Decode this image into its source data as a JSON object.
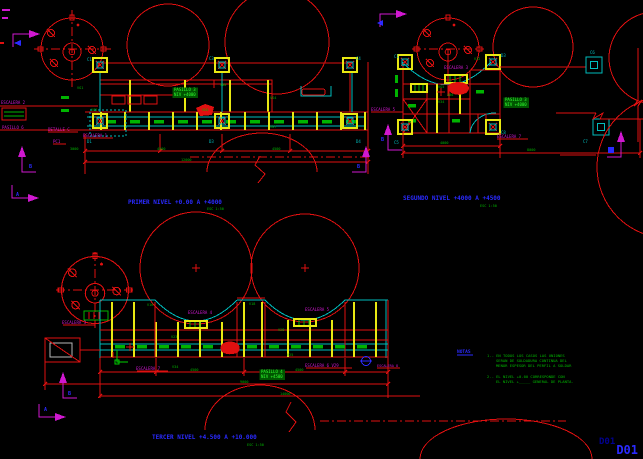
{
  "meta": {
    "sheet_code": "D01",
    "background": "#000000",
    "app_kind": "cad-model-space"
  },
  "palette": {
    "red": "#e01010",
    "yellow": "#e8e812",
    "green": "#00b400",
    "hl": "#30ff30",
    "hl_bg": "#005500",
    "cyan": "#00bcbc",
    "magenta": "#d018d0",
    "blue": "#2a2aff",
    "navy": "#000090",
    "gray": "#b8b8b8"
  },
  "drawings_summary": [
    {
      "id": "primer-nivel",
      "title": "PRIMER NIVEL +0.00 A +4000",
      "scale": "ESC 1:50"
    },
    {
      "id": "segundo-nivel",
      "title": "SEGUNDO NIVEL +4000 A +4500",
      "scale": "ESC 1:50"
    },
    {
      "id": "tercer-nivel",
      "title": "TERCER NIVEL +4.500 A +10.000",
      "scale": "ESC 1:50"
    }
  ],
  "texts": [
    {
      "name": "grid-bubble-c1",
      "t": "C1",
      "x": 87,
      "y": 61,
      "c": "cyan"
    },
    {
      "name": "grid-bubble-c3",
      "t": "C3",
      "x": 209,
      "y": 60,
      "c": "cyan"
    },
    {
      "name": "grid-bubble-c4",
      "t": "C4",
      "x": 356,
      "y": 60,
      "c": "cyan"
    },
    {
      "name": "grid-bubble-d1",
      "t": "D1",
      "x": 87,
      "y": 143,
      "c": "cyan"
    },
    {
      "name": "grid-bubble-d3",
      "t": "D3",
      "x": 209,
      "y": 143,
      "c": "cyan"
    },
    {
      "name": "grid-bubble-d4",
      "t": "D4",
      "x": 356,
      "y": 143,
      "c": "cyan"
    },
    {
      "name": "beam-label",
      "t": "VG1",
      "x": 77,
      "y": 89,
      "c": "green",
      "s": 3.5
    },
    {
      "name": "beam-label",
      "t": "VG5",
      "x": 91,
      "y": 111,
      "c": "green",
      "s": 3.5
    },
    {
      "name": "beam-label",
      "t": "VG4",
      "x": 202,
      "y": 111,
      "c": "green",
      "s": 3.5
    },
    {
      "name": "beam-label",
      "t": "VS4",
      "x": 270,
      "y": 99,
      "c": "green",
      "s": 3.5
    },
    {
      "name": "beam-label",
      "t": "VG7",
      "x": 270,
      "y": 128,
      "c": "green",
      "s": 3.5
    },
    {
      "name": "elev-label",
      "t": "400",
      "x": 220,
      "y": 86,
      "c": "green",
      "s": 3.5
    },
    {
      "name": "pasillo-note",
      "t": "PASILLO 3",
      "x": 174,
      "y": 91,
      "c": "hl",
      "s": 4,
      "hl": 1
    },
    {
      "name": "pasillo-note",
      "t": "NIV +4000",
      "x": 174,
      "y": 96,
      "c": "hl",
      "s": 4,
      "hl": 1
    },
    {
      "name": "label-escalera-2",
      "t": "ESCALERA 2",
      "x": 1,
      "y": 104,
      "c": "magenta"
    },
    {
      "name": "label-pasillo-6",
      "t": "PASILLO 6",
      "x": 2,
      "y": 129,
      "c": "magenta"
    },
    {
      "name": "label-detalle-c",
      "t": "DETALLE C",
      "x": 48,
      "y": 131,
      "c": "magenta"
    },
    {
      "name": "label-escalera-1",
      "t": "ESCALERA 1",
      "x": 83,
      "y": 137,
      "c": "magenta"
    },
    {
      "name": "label-pc1",
      "t": "PC1",
      "x": 53,
      "y": 143,
      "c": "magenta"
    },
    {
      "name": "dim-value",
      "t": "3000",
      "x": 70,
      "y": 150,
      "c": "green",
      "s": 3.5
    },
    {
      "name": "dim-value",
      "t": "4500",
      "x": 157,
      "y": 150,
      "c": "green",
      "s": 3.5
    },
    {
      "name": "dim-value",
      "t": "4500",
      "x": 272,
      "y": 150,
      "c": "green",
      "s": 3.5
    },
    {
      "name": "dim-value",
      "t": "12000",
      "x": 181,
      "y": 161,
      "c": "green",
      "s": 3.5
    },
    {
      "name": "section-letter",
      "t": "B",
      "x": 29,
      "y": 168,
      "c": "blue",
      "s": 5,
      "b": 1
    },
    {
      "name": "section-letter",
      "t": "B",
      "x": 357,
      "y": 168,
      "c": "blue",
      "s": 5,
      "b": 1
    },
    {
      "name": "section-letter",
      "t": "A",
      "x": 16,
      "y": 196,
      "c": "blue",
      "s": 5,
      "b": 1
    },
    {
      "name": "title-primer-nivel",
      "t": "PRIMER NIVEL +0.00 A +4000",
      "x": 128,
      "y": 204,
      "c": "blue",
      "s": 6,
      "b": 1
    },
    {
      "name": "scale-note",
      "t": "ESC 1:50",
      "x": 207,
      "y": 210,
      "c": "green",
      "s": 3.5
    },
    {
      "name": "label-escalera-3",
      "t": "ESCALERA 3",
      "x": 444,
      "y": 69,
      "c": "magenta"
    },
    {
      "name": "label-escalera-5",
      "t": "ESCALERA 5",
      "x": 371,
      "y": 111,
      "c": "magenta"
    },
    {
      "name": "label-escalera-7",
      "t": "ESCALERA 7",
      "x": 497,
      "y": 138,
      "c": "magenta"
    },
    {
      "name": "grid-bubble-c1",
      "t": "C1",
      "x": 394,
      "y": 58,
      "c": "cyan"
    },
    {
      "name": "grid-bubble-d3",
      "t": "D3",
      "x": 501,
      "y": 57,
      "c": "cyan"
    },
    {
      "name": "grid-bubble-c5",
      "t": "C5",
      "x": 394,
      "y": 144,
      "c": "cyan"
    },
    {
      "name": "grid-bubble-c8",
      "t": "C8",
      "x": 501,
      "y": 134,
      "c": "cyan"
    },
    {
      "name": "grid-bubble-c6",
      "t": "C6",
      "x": 590,
      "y": 54,
      "c": "cyan"
    },
    {
      "name": "grid-bubble-c7",
      "t": "C7",
      "x": 583,
      "y": 143,
      "c": "cyan"
    },
    {
      "name": "beam-label",
      "t": "V12",
      "x": 474,
      "y": 60,
      "c": "green",
      "s": 3.5
    },
    {
      "name": "beam-label",
      "t": "VG5",
      "x": 438,
      "y": 88,
      "c": "green",
      "s": 3.5
    },
    {
      "name": "beam-label",
      "t": "V34",
      "x": 438,
      "y": 103,
      "c": "green",
      "s": 3.5
    },
    {
      "name": "elev-label",
      "t": "400",
      "x": 447,
      "y": 96,
      "c": "green",
      "s": 3.5
    },
    {
      "name": "pasillo-note",
      "t": "PASILLO 3",
      "x": 505,
      "y": 101,
      "c": "hl",
      "s": 4,
      "hl": 1
    },
    {
      "name": "pasillo-note",
      "t": "NIV +4000",
      "x": 505,
      "y": 106,
      "c": "hl",
      "s": 4,
      "hl": 1
    },
    {
      "name": "dim-value",
      "t": "4000",
      "x": 440,
      "y": 144,
      "c": "green",
      "s": 3.5
    },
    {
      "name": "dim-value",
      "t": "8000",
      "x": 527,
      "y": 151,
      "c": "green",
      "s": 3.5
    },
    {
      "name": "section-letter",
      "t": "B",
      "x": 381,
      "y": 141,
      "c": "blue",
      "s": 5,
      "b": 1
    },
    {
      "name": "title-segundo-nivel",
      "t": "SEGUNDO NIVEL +4000 A +4500",
      "x": 403,
      "y": 200,
      "c": "blue",
      "s": 6,
      "b": 1
    },
    {
      "name": "scale-note",
      "t": "ESC 1:50",
      "x": 480,
      "y": 207,
      "c": "green",
      "s": 3.5
    },
    {
      "name": "label-escalera-3",
      "t": "ESCALERA 3",
      "x": 62,
      "y": 324,
      "c": "magenta"
    },
    {
      "name": "label-escalera-4",
      "t": "ESCALERA 4",
      "x": 188,
      "y": 314,
      "c": "magenta"
    },
    {
      "name": "label-escalera-5",
      "t": "ESCALERA 5",
      "x": 305,
      "y": 311,
      "c": "magenta"
    },
    {
      "name": "label-escalera-7",
      "t": "ESCALERA 7",
      "x": 136,
      "y": 370,
      "c": "magenta"
    },
    {
      "name": "label-escalera-6",
      "t": "ESCALERA 6 V29",
      "x": 305,
      "y": 367,
      "c": "magenta"
    },
    {
      "name": "label-escalera-8",
      "t": "ESCALERA 8",
      "x": 377,
      "y": 367,
      "c": "magenta",
      "s": 3.5
    },
    {
      "name": "beam-label",
      "t": "V16",
      "x": 147,
      "y": 306,
      "c": "green",
      "s": 3.5
    },
    {
      "name": "beam-label",
      "t": "V18",
      "x": 249,
      "y": 305,
      "c": "green",
      "s": 3.5
    },
    {
      "name": "beam-label",
      "t": "V28",
      "x": 278,
      "y": 331,
      "c": "green",
      "s": 3.5
    },
    {
      "name": "beam-label",
      "t": "V23",
      "x": 171,
      "y": 338,
      "c": "green",
      "s": 3.5
    },
    {
      "name": "beam-label",
      "t": "V25",
      "x": 287,
      "y": 356,
      "c": "green",
      "s": 3.5
    },
    {
      "name": "beam-label",
      "t": "V34",
      "x": 172,
      "y": 368,
      "c": "green",
      "s": 3.5
    },
    {
      "name": "pasillo-note",
      "t": "PASILLO 4",
      "x": 261,
      "y": 373,
      "c": "hl",
      "s": 4,
      "hl": 1
    },
    {
      "name": "pasillo-note",
      "t": "NIV +4500",
      "x": 261,
      "y": 378,
      "c": "hl",
      "s": 4,
      "hl": 1
    },
    {
      "name": "dim-value",
      "t": "4500",
      "x": 190,
      "y": 371,
      "c": "green",
      "s": 3.5
    },
    {
      "name": "dim-value",
      "t": "4500",
      "x": 295,
      "y": 371,
      "c": "green",
      "s": 3.5
    },
    {
      "name": "dim-value",
      "t": "9000",
      "x": 240,
      "y": 383,
      "c": "green",
      "s": 3.5
    },
    {
      "name": "dim-value",
      "t": "14000",
      "x": 280,
      "y": 395,
      "c": "green",
      "s": 3.5
    },
    {
      "name": "section-letter",
      "t": "B",
      "x": 68,
      "y": 395,
      "c": "blue",
      "s": 5,
      "b": 1
    },
    {
      "name": "section-letter",
      "t": "A",
      "x": 44,
      "y": 411,
      "c": "blue",
      "s": 5,
      "b": 1
    },
    {
      "name": "title-tercer-nivel",
      "t": "TERCER NIVEL +4.500 A +10.000",
      "x": 152,
      "y": 439,
      "c": "blue",
      "s": 6,
      "b": 1
    },
    {
      "name": "scale-note",
      "t": "ESC 1:50",
      "x": 247,
      "y": 446,
      "c": "green",
      "s": 3.5
    },
    {
      "name": "notas-heading",
      "t": "NOTAS",
      "x": 457,
      "y": 353,
      "c": "blue",
      "s": 4.5,
      "b": 1
    },
    {
      "name": "note-line",
      "t": "1.- EN TODOS LOS CASOS LAS UNIONES",
      "x": 487,
      "y": 357,
      "c": "green",
      "s": 3.8
    },
    {
      "name": "note-line",
      "t": "SERAN DE SOLDADURA CONTINUA DEL",
      "x": 496,
      "y": 362,
      "c": "green",
      "s": 3.8
    },
    {
      "name": "note-line",
      "t": "MENOR ESPESOR DEL PERFIL A SOLDAR",
      "x": 496,
      "y": 367,
      "c": "green",
      "s": 3.8
    },
    {
      "name": "note-line",
      "t": "2.- EL NIVEL +0.00 CORRESPONDE CON",
      "x": 487,
      "y": 378,
      "c": "green",
      "s": 3.8
    },
    {
      "name": "note-line",
      "t": "EL NIVEL +_____ GENERAL DE PLANTA.",
      "x": 496,
      "y": 383,
      "c": "green",
      "s": 3.8
    },
    {
      "name": "sheet-code-echo",
      "t": "D01",
      "x": 599,
      "y": 444,
      "c": "#000090",
      "s": 9,
      "b": 1
    }
  ]
}
